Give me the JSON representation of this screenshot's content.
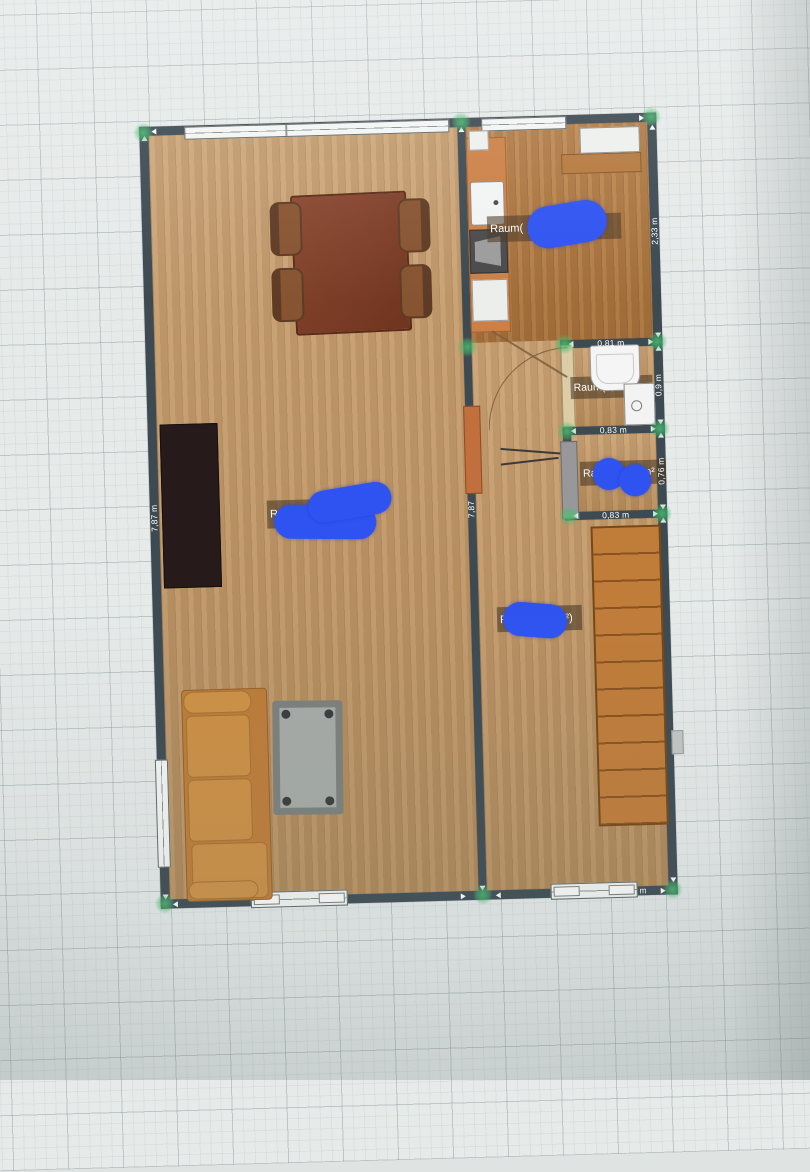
{
  "plan": {
    "room_labels": {
      "kitchen": {
        "prefix": "Raum(",
        "suffix": "m²)"
      },
      "living": {
        "prefix": "R",
        "suffix": ")"
      },
      "bathroom": {
        "text": "Raum(0,7"
      },
      "storage": {
        "prefix": "Raum(",
        "suffix": "m²"
      },
      "hallway": {
        "prefix": "Rau",
        "suffix": "m²)"
      }
    },
    "dimensions": {
      "left_wall": "7,87 m",
      "center_wall": "7,87",
      "kitchen_right": "2,33 m",
      "bathroom_top": "0,81 m",
      "bathroom_right": "0,9 m",
      "bathroom_bottom": "0,83 m",
      "storage_right": "0,76 m",
      "storage_bottom": "0,83 m",
      "bottom_partial": "m"
    },
    "colors": {
      "wall": "#3d4a52",
      "floor_light": "#c49a69",
      "floor_kitchen": "#b0793f",
      "accent_orange": "#c97f3e",
      "marker_green": "#48be70",
      "annotation_blue": "#2e53f1"
    }
  }
}
